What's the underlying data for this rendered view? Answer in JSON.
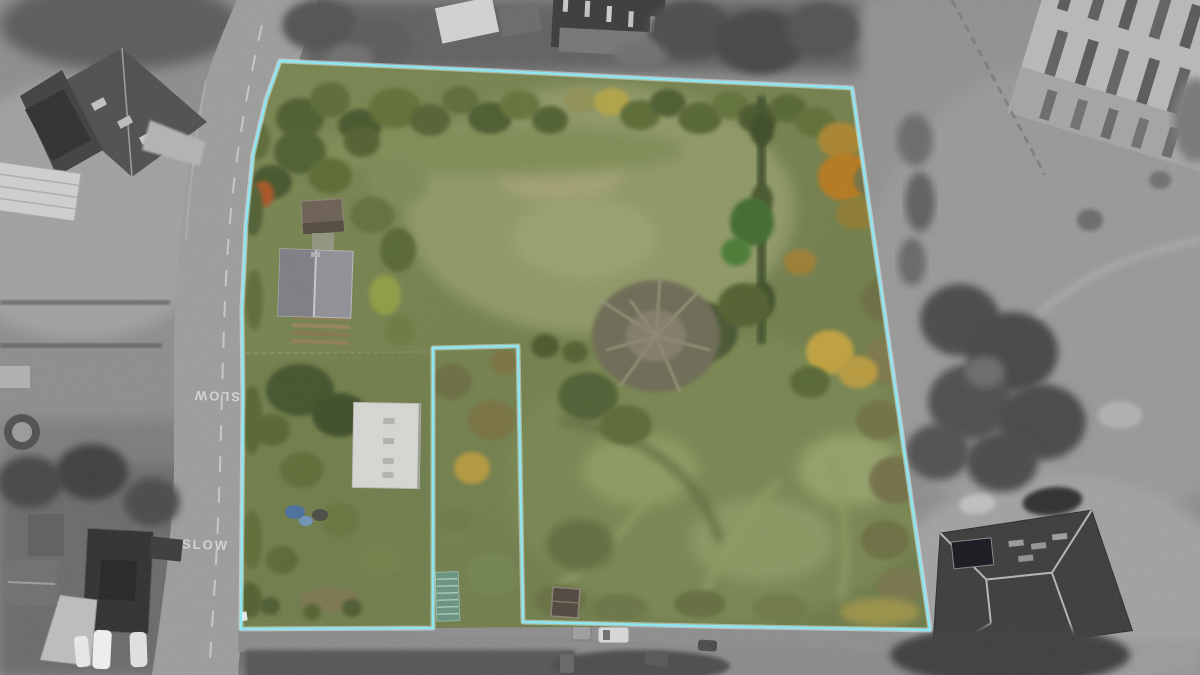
{
  "scene": {
    "kind": "aerial-drone-photograph",
    "road_markings": {
      "north": "SLOW",
      "south": "SLOW"
    }
  },
  "boundary": {
    "stroke_color": "#8de6f2",
    "glow_color": "#eafcff",
    "outer_with_notch": [
      [
        280,
        61
      ],
      [
        500,
        71
      ],
      [
        700,
        81
      ],
      [
        852,
        88
      ],
      [
        930,
        630
      ],
      [
        700,
        626
      ],
      [
        523,
        622
      ],
      [
        518,
        346
      ],
      [
        433,
        348
      ],
      [
        433,
        628
      ],
      [
        241,
        629
      ],
      [
        242,
        520
      ],
      [
        243,
        400
      ],
      [
        242,
        310
      ],
      [
        246,
        225
      ],
      [
        253,
        155
      ],
      [
        266,
        100
      ]
    ],
    "hull": [
      [
        280,
        61
      ],
      [
        500,
        71
      ],
      [
        700,
        81
      ],
      [
        852,
        88
      ],
      [
        930,
        630
      ],
      [
        700,
        626
      ],
      [
        433,
        628
      ],
      [
        241,
        629
      ],
      [
        242,
        520
      ],
      [
        243,
        400
      ],
      [
        242,
        310
      ],
      [
        246,
        225
      ],
      [
        253,
        155
      ],
      [
        266,
        100
      ]
    ]
  },
  "palette": {
    "grass": "#75824f",
    "grass_light": "#8e9765",
    "hedge_dark": "#47572a",
    "autumn_orange": "#b5791f",
    "autumn_yellow": "#c0a13e",
    "grayscale_base": "#8d8d8d",
    "road_gray": "#9c9c9c"
  }
}
